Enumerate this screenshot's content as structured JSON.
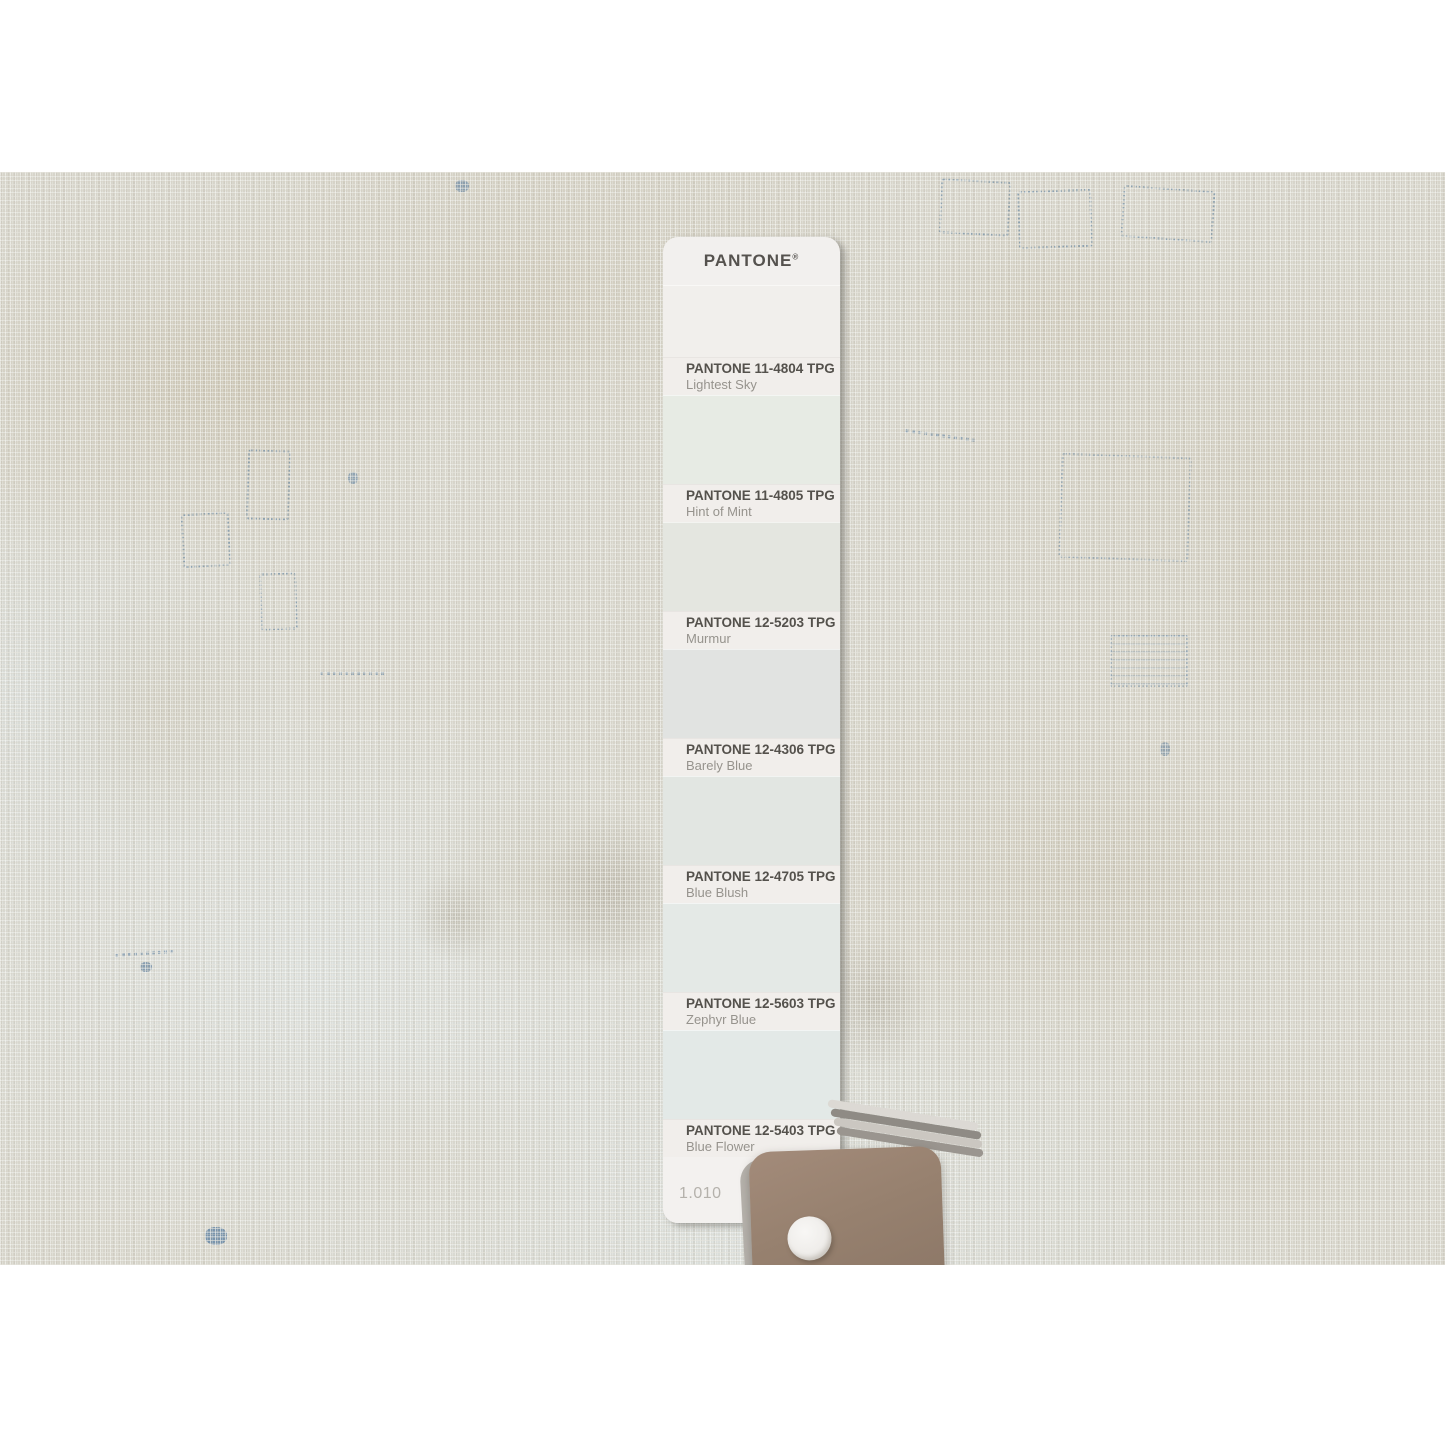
{
  "strip": {
    "brand": "PANTONE",
    "registered_mark": "®",
    "page_number": "1.010",
    "label_band_color": "#f1eeeb",
    "card_base_color": "#f2f0ee",
    "swatches": [
      {
        "code": "PANTONE 11-4804 TPG",
        "name": "Lightest Sky",
        "color": "#f1efec"
      },
      {
        "code": "PANTONE 11-4805 TPG",
        "name": "Hint of Mint",
        "color": "#e7ebe4"
      },
      {
        "code": "PANTONE 12-5203 TPG",
        "name": "Murmur",
        "color": "#e4e6e0"
      },
      {
        "code": "PANTONE 12-4306 TPG",
        "name": "Barely Blue",
        "color": "#e1e3e1"
      },
      {
        "code": "PANTONE 12-4705 TPG",
        "name": "Blue Blush",
        "color": "#e2e6e2"
      },
      {
        "code": "PANTONE 12-5603 TPG",
        "name": "Zephyr Blue",
        "color": "#e4e9e6"
      },
      {
        "code": "PANTONE 12-5403 TPG",
        "name": "Blue Flower",
        "color": "#e3e9e7"
      }
    ]
  },
  "fan_deck": {
    "top_card_color": "#9c8674",
    "rivet_color": "#f3f2f0"
  },
  "fabric": {
    "base_color": "#d7d5cb",
    "thread_color": "#f6f7f4",
    "stitch_color": "#5d84a6"
  }
}
